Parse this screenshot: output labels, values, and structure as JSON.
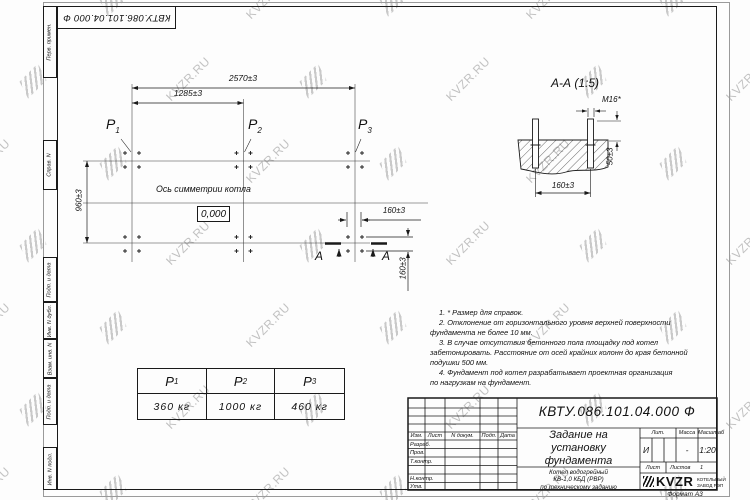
{
  "watermark": {
    "text": "KVZR.RU"
  },
  "corner_stamp": {
    "number": "КВТУ.086.101.04.000  Ф"
  },
  "margin": {
    "labels": [
      "Перв. примен.",
      "Справ. N",
      "Подп. и дата",
      "Инв. N дубл.",
      "Взам. инв. N",
      "Подп. и дата",
      "Инв. N подл."
    ]
  },
  "plan": {
    "dim_total": "2570±3",
    "dim_half": "1285±3",
    "dim_depth": "960±3",
    "dim_bolt_x": "160±3",
    "dim_bolt_y": "160±3",
    "axis_label": "Ось симметрии котла",
    "level_mark": "0,000",
    "p_labels": [
      {
        "base": "P",
        "sub": "1"
      },
      {
        "base": "P",
        "sub": "2"
      },
      {
        "base": "P",
        "sub": "3"
      }
    ],
    "section_letter_left": "A",
    "section_letter_right": "A"
  },
  "section_view": {
    "title": "А-А (1:5)",
    "thread_label": "M16*",
    "dim_spacing": "160±3",
    "dim_protrusion": "50±3"
  },
  "notes": {
    "lines": [
      "1. * Размер для справок.",
      "2. Отклонение от горизонтального уровня верхней поверхности",
      "фундамента не более 10 мм.",
      "3. В случае отсутствия бетонного пола площадку под котел",
      "забетонировать. Расстояние от осей крайних колонн до края бетонной",
      "подушки 500 мм.",
      "4. Фундамент под котел разрабатывает проектная организация",
      "по нагрузкам на фундамент."
    ]
  },
  "load_table": {
    "columns": [
      {
        "base": "P",
        "sub": "1",
        "value": "360 кг"
      },
      {
        "base": "P",
        "sub": "2",
        "value": "1000 кг"
      },
      {
        "base": "P",
        "sub": "3",
        "value": "460 кг"
      }
    ]
  },
  "title_block": {
    "doc_number": "КВТУ.086.101.04.000  Ф",
    "rev_header": [
      "Изм.",
      "Лист",
      "N докум.",
      "Подп.",
      "Дата"
    ],
    "sign_rows": [
      "Разраб.",
      "Пров.",
      "Т.контр.",
      "",
      "Н.контр.",
      "Утв."
    ],
    "title_lines": [
      "Задание на",
      "установку",
      "фундамента"
    ],
    "subtitle_lines": [
      "Котел водогрейный",
      "КВ-1,0 КБД (РВР)",
      "по техническому заданию"
    ],
    "lit_header": "Лит.",
    "mass_header": "Масса",
    "scale_header": "Масштаб",
    "lit_value": "И",
    "mass_value": "-",
    "scale_value": "1:20",
    "sheet_label": "Лист",
    "sheets_label": "Листов",
    "sheets_value": "1",
    "brand": "KVZR",
    "brand_line1": "КОТЕЛЬНЫЙ",
    "brand_line2": "ЗАВОД РЭП",
    "format_label": "Формат А3"
  }
}
